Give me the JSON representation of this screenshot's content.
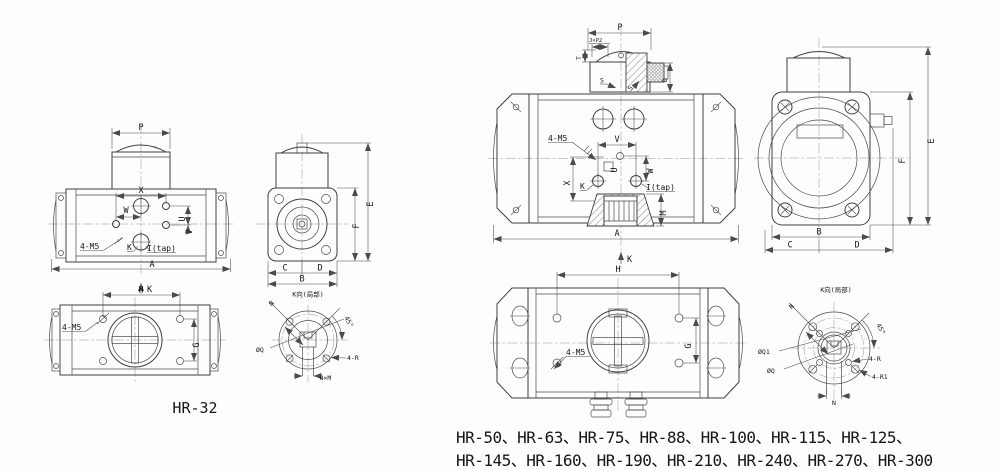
{
  "drawing": {
    "left": {
      "model": "HR-32",
      "front": {
        "p": "P",
        "x": "X",
        "w": "W",
        "u": "U",
        "v": "V",
        "k": "K",
        "itap": "I(tap)",
        "m5": "4-M5",
        "a": "A",
        "view_k": "K"
      },
      "side": {
        "e": "E",
        "f": "F",
        "c": "C",
        "d": "D",
        "b": "B"
      },
      "bottom": {
        "h": "H",
        "g": "G",
        "m5": "4-M5"
      },
      "kview": {
        "title": "K向(局部)",
        "n": "N",
        "angle": "45°",
        "q": "ØQ",
        "r": "4-R",
        "nxm": "N×M"
      }
    },
    "right": {
      "models_line1": "HR-50、HR-63、HR-75、HR-88、HR-100、HR-115、HR-125、",
      "models_line2": "HR-145、HR-160、HR-190、HR-210、HR-240、HR-270、HR-300",
      "front": {
        "p": "P",
        "jp2": "J×P2",
        "t": "T",
        "s1": "S",
        "s2": "S",
        "d": "D",
        "m5": "4-M5",
        "v": "V",
        "u": "U",
        "w": "W",
        "x": "X",
        "k": "K",
        "itap": "I(tap)",
        "m": "M",
        "a": "A",
        "view_k": "K"
      },
      "side": {
        "e": "E",
        "f": "F",
        "b": "B",
        "c": "C",
        "d": "D"
      },
      "bottom": {
        "h": "H",
        "g": "G",
        "m5": "4-M5"
      },
      "kview": {
        "title": "K向(局部)",
        "n": "N",
        "angle": "45°",
        "q1": "ØQ1",
        "q": "ØQ",
        "r": "4-R",
        "r1": "4-R1",
        "n2": "N"
      }
    }
  }
}
